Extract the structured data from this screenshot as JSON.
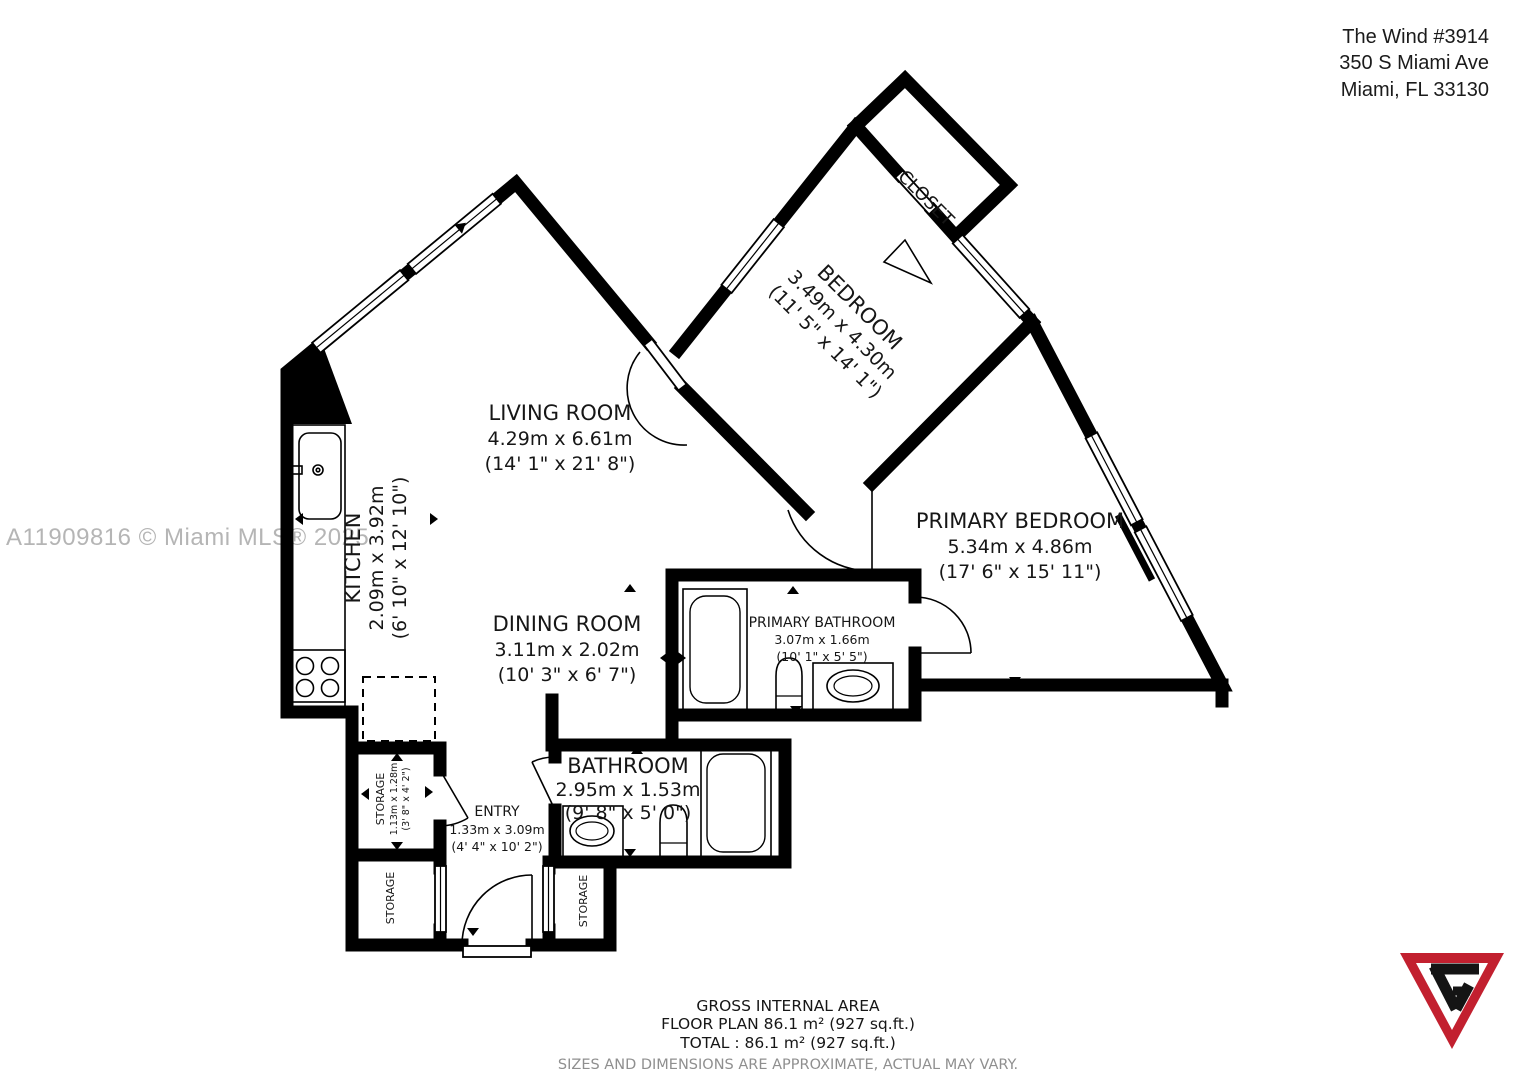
{
  "header": {
    "line1": "The Wind #3914",
    "line2": "350 S Miami Ave",
    "line3": "Miami, FL 33130"
  },
  "watermark": "A11909816 © Miami MLS® 2025",
  "rooms": {
    "living": {
      "name": "LIVING ROOM",
      "metric": "4.29m x 6.61m",
      "imperial": "(14' 1\" x 21' 8\")"
    },
    "kitchen": {
      "name": "KITCHEN",
      "metric": "2.09m x 3.92m",
      "imperial": "(6' 10\" x 12' 10\")"
    },
    "dining": {
      "name": "DINING ROOM",
      "metric": "3.11m x 2.02m",
      "imperial": "(10' 3\" x 6' 7\")"
    },
    "bedroom": {
      "name": "BEDROOM",
      "metric": "3.49m x 4.30m",
      "imperial": "(11' 5\" x 14' 1\")"
    },
    "closet": {
      "name": "CLOSET"
    },
    "primary_bedroom": {
      "name": "PRIMARY BEDROOM",
      "metric": "5.34m x 4.86m",
      "imperial": "(17' 6\" x 15' 11\")"
    },
    "primary_bathroom": {
      "name": "PRIMARY BATHROOM",
      "metric": "3.07m x 1.66m",
      "imperial": "(10' 1\" x 5' 5\")"
    },
    "bathroom": {
      "name": "BATHROOM",
      "metric": "2.95m x 1.53m",
      "imperial": "(9' 8\" x 5' 0\")"
    },
    "entry": {
      "name": "ENTRY",
      "metric": "1.33m x 3.09m",
      "imperial": "(4' 4\" x 10' 2\")"
    },
    "storage_a": {
      "name": "STORAGE",
      "metric": "1.13m x 1.28m",
      "imperial": "(3' 8\" x 4' 2\")"
    },
    "storage_b": {
      "name": "STORAGE"
    },
    "storage_c": {
      "name": "STORAGE"
    }
  },
  "footer": {
    "line1": "GROSS INTERNAL AREA",
    "line2": "FLOOR PLAN 86.1 m² (927 sq.ft.)",
    "line3": "TOTAL :  86.1 m² (927 sq.ft.)",
    "disclaimer": "SIZES AND DIMENSIONS ARE APPROXIMATE, ACTUAL MAY VARY."
  },
  "colors": {
    "wall": "#000000",
    "text": "#161616",
    "muted": "#8f8f8f",
    "watermark": "#b5b5b5",
    "logo_red": "#c2202f",
    "logo_black": "#141414"
  }
}
